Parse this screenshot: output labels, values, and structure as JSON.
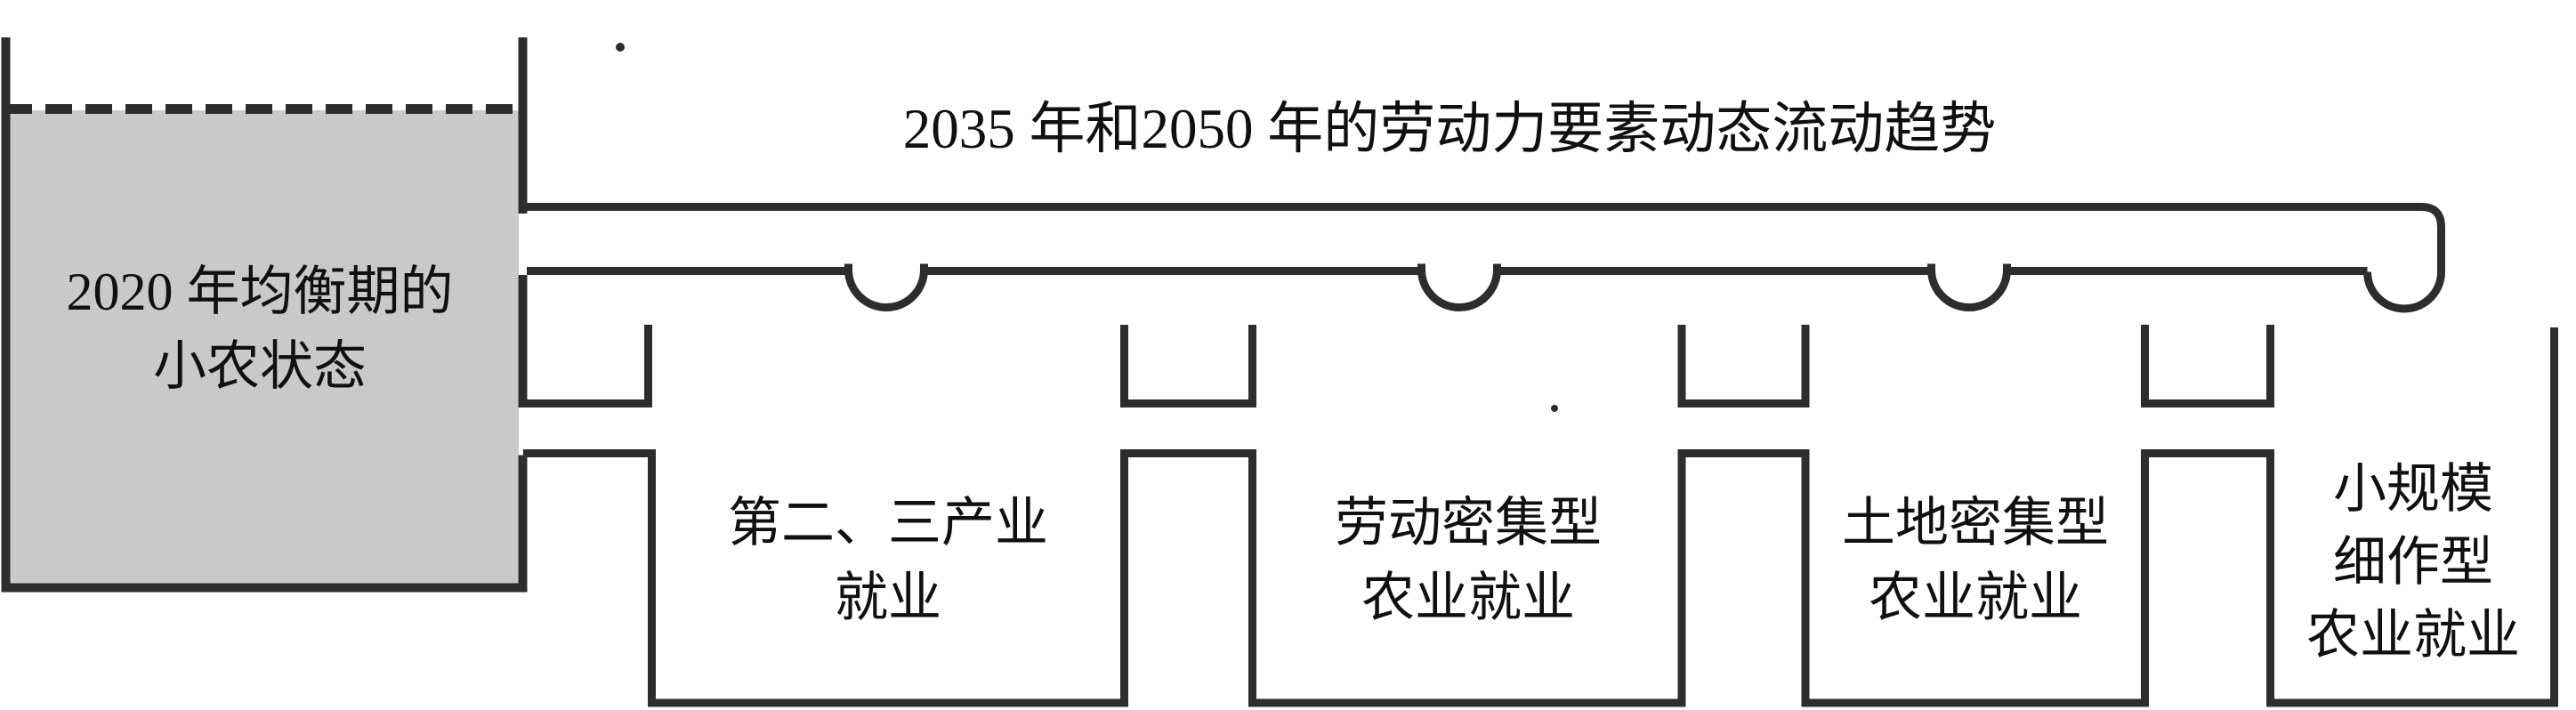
{
  "colors": {
    "line": "#2d2d2d",
    "tank-fill": "#c9c9c9",
    "text": "#101010",
    "background": "#ffffff"
  },
  "pipe": {
    "title": "2035 年和2050 年的劳动力要素动态流动趋势"
  },
  "tank": {
    "label_lines": [
      "2020 年均衡期的",
      "小农状态"
    ]
  },
  "containers": [
    {
      "name": "secondary-tertiary-industry-employment",
      "label_lines": [
        "第二、三产业",
        "就业"
      ]
    },
    {
      "name": "labor-intensive-agriculture-employment",
      "label_lines": [
        "劳动密集型",
        "农业就业"
      ]
    },
    {
      "name": "land-intensive-agriculture-employment",
      "label_lines": [
        "土地密集型",
        "农业就业"
      ]
    },
    {
      "name": "small-scale-intensive-agriculture-employment",
      "label_lines": [
        "小规模",
        "细作型",
        "农业就业"
      ]
    }
  ]
}
